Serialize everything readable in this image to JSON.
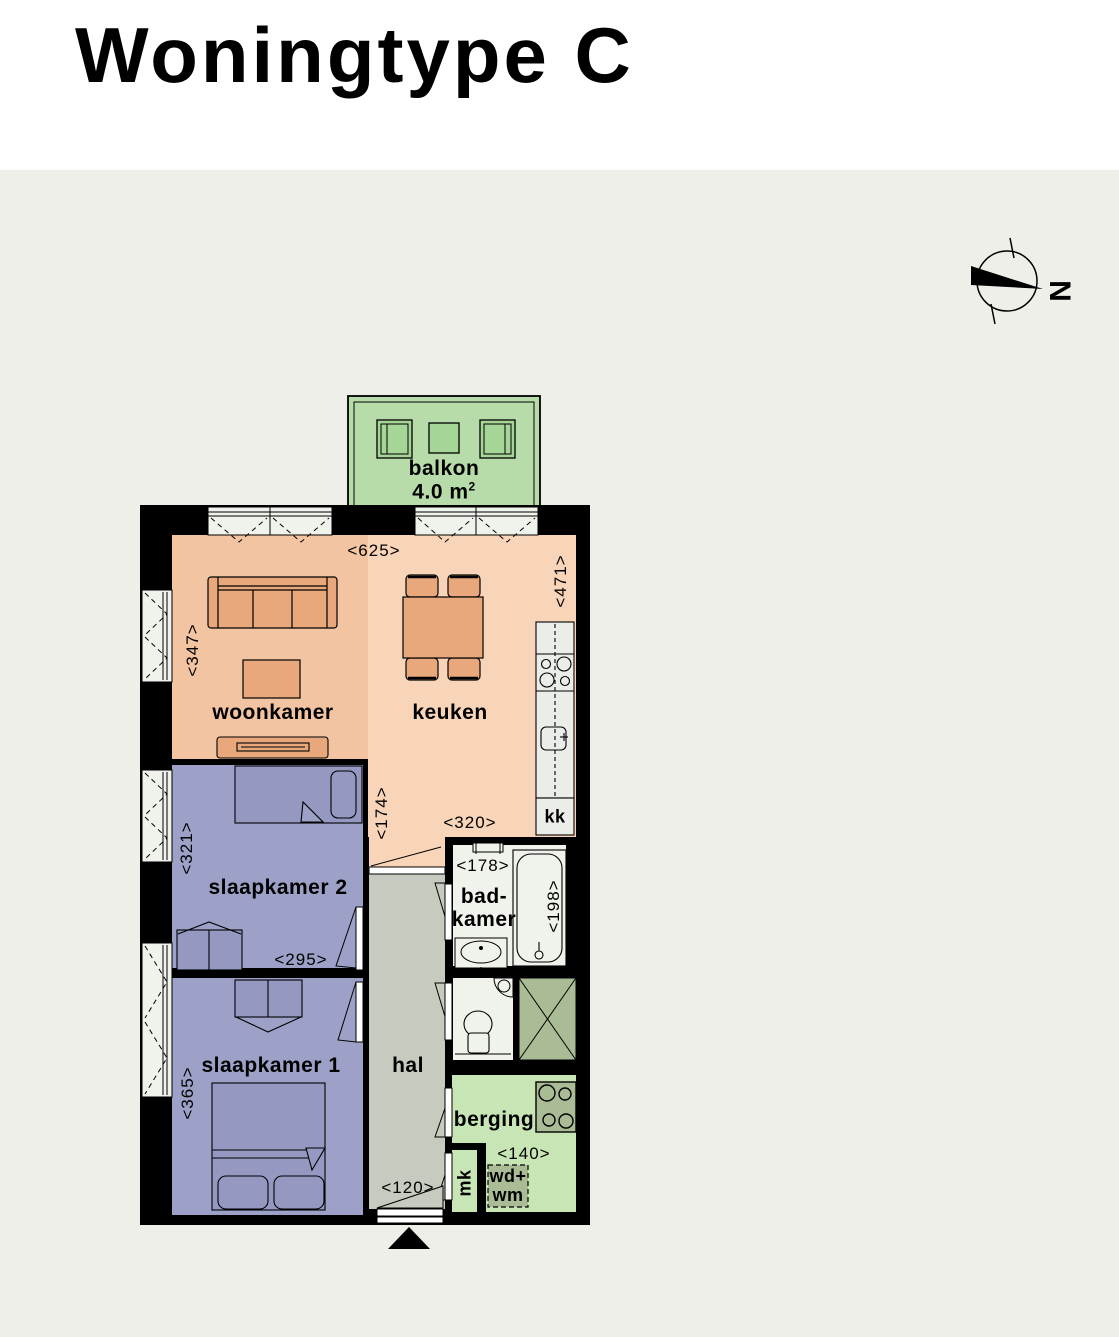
{
  "title": "Woningtype C",
  "compass": {
    "north_letter": "N"
  },
  "balcony": {
    "label": "balkon",
    "area_value": "4.0 m",
    "area_sup": "2"
  },
  "rooms": {
    "woonkamer": {
      "label": "woonkamer"
    },
    "keuken": {
      "label": "keuken"
    },
    "slaapkamer2": {
      "label": "slaapkamer 2"
    },
    "slaapkamer1": {
      "label": "slaapkamer 1"
    },
    "hal": {
      "label": "hal"
    },
    "badkamer": {
      "label_line1": "bad-",
      "label_line2": "kamer"
    },
    "berging": {
      "label": "berging"
    }
  },
  "labels": {
    "kk": "kk",
    "mk": "mk",
    "wd_wm_line1": "wd+",
    "wd_wm_line2": "wm"
  },
  "dimensions": {
    "total_width": "<625>",
    "keuken_depth": "<471>",
    "woonkamer_depth": "<347>",
    "keuken_passage": "<174>",
    "keuken_width": "<320>",
    "badkamer_width": "<178>",
    "badkamer_depth": "<198>",
    "slaapkamer2_depth": "<321>",
    "slaapkamer2_width": "<295>",
    "slaapkamer1_depth": "<365>",
    "hal_width": "<120>",
    "berging_width": "<140>"
  },
  "colors": {
    "page_background": "#edefe8",
    "wall": "#000000",
    "woonkamer": "#f2c4a1",
    "keuken": "#f8d4b8",
    "furniture_orange": "#e9a87c",
    "bedroom": "#9da1c7",
    "bedroom_furniture": "#9599c2",
    "hal": "#c6cbc0",
    "sanitary_white": "#f0f2ec",
    "counter_white": "#ebeee8",
    "balcony_green": "#b7dcaa",
    "planter_green": "#a6d598",
    "berging_green": "#c8e5b5",
    "installation_green": "#a9bc95"
  }
}
